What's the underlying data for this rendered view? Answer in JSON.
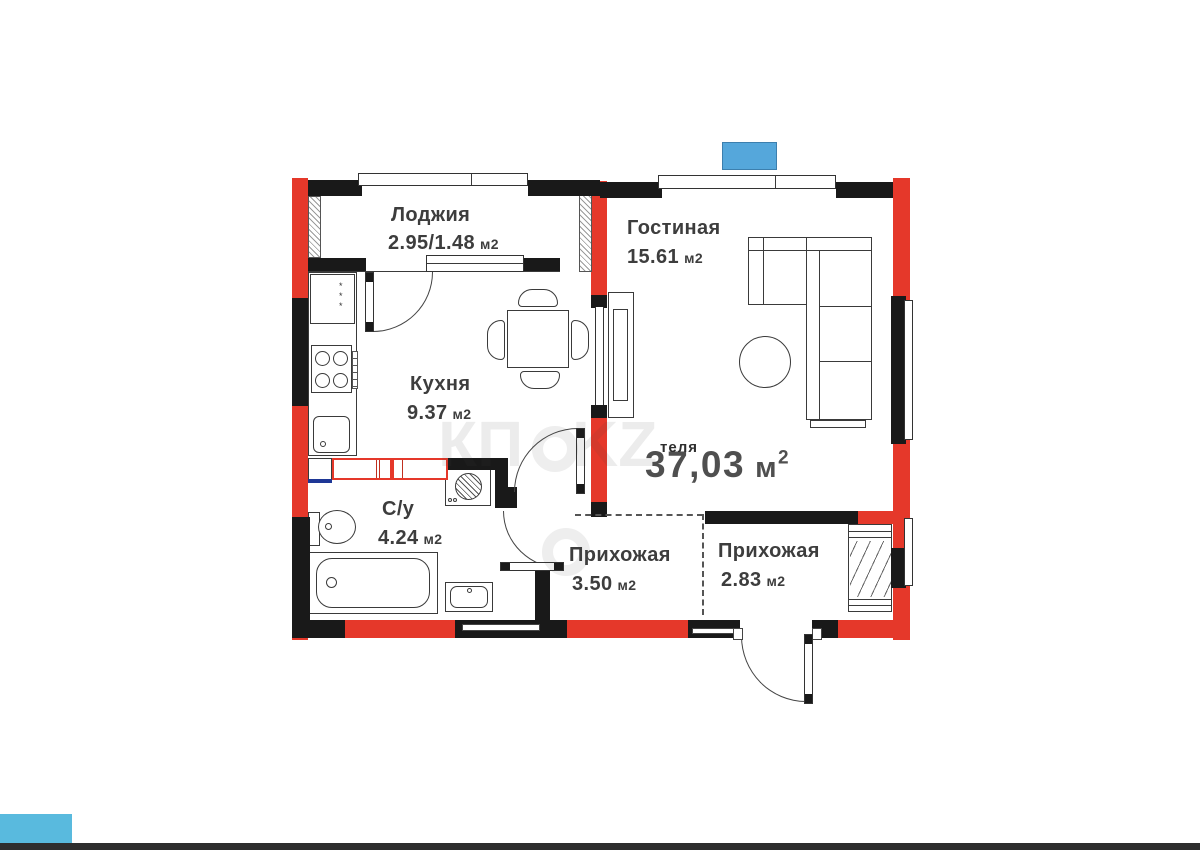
{
  "plan": {
    "rooms": [
      {
        "name": "Лоджия",
        "area": "2.95/1.48",
        "unit": "м2"
      },
      {
        "name": "Гостиная",
        "area": "15.61",
        "unit": "м2"
      },
      {
        "name": "Кухня",
        "area": "9.37",
        "unit": "м2"
      },
      {
        "name": "С/у",
        "area": "4.24",
        "unit": "м2"
      },
      {
        "name": "Прихожая",
        "area": "3.50",
        "unit": "м2"
      },
      {
        "name": "Прихожая",
        "area": "2.83",
        "unit": "м2"
      }
    ],
    "total": {
      "value": "37,03",
      "unit": "м",
      "sup": "2",
      "overlap_fragment": "теля"
    },
    "watermark": {
      "left": "КП",
      "right": "KZ"
    },
    "fridge_marks": "*\n*\n*"
  },
  "colors": {
    "wall_red": "#e5382a",
    "wall_black": "#191919",
    "blue_marker": "#55a7db",
    "blue_corner": "#59bade",
    "bottom_bar": "#2e2e2e",
    "text": "#3d3d3d"
  }
}
